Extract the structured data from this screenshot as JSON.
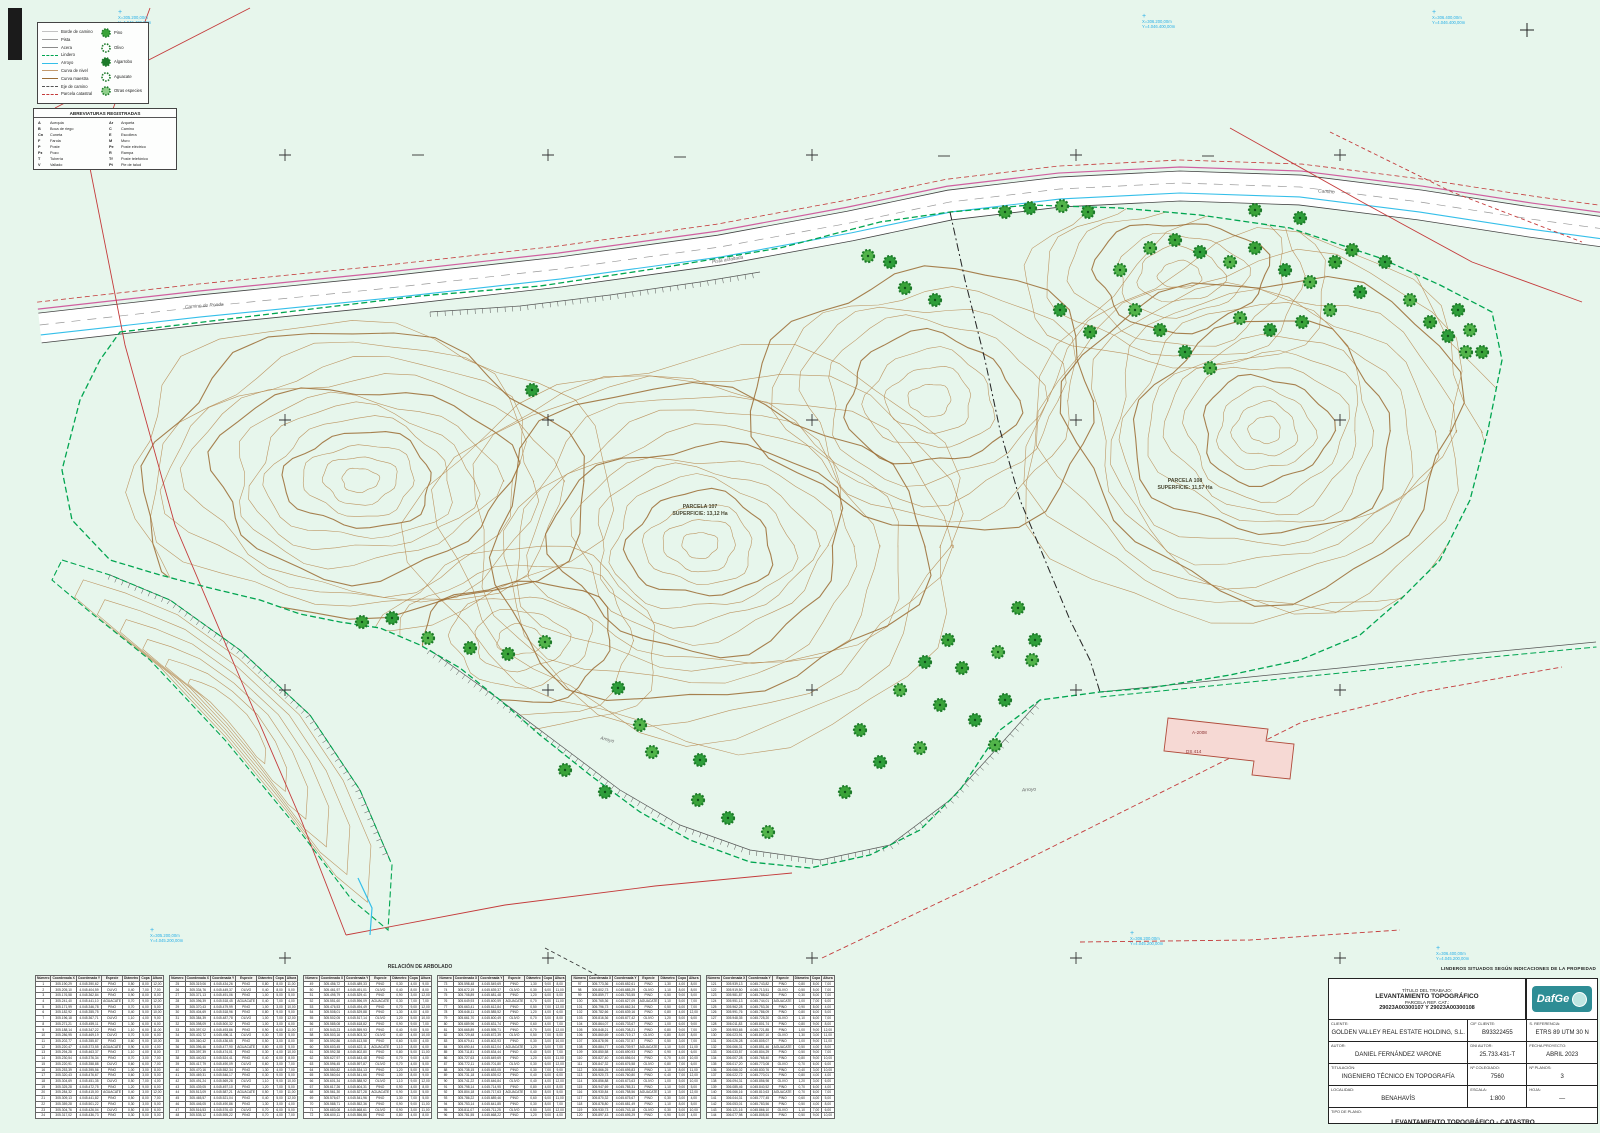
{
  "colors": {
    "bg": "#e7f6ec",
    "contour": "#b5854a",
    "contour_index": "#9a6b33",
    "tree": "#3aa339",
    "tree_dark": "#1d7a2a",
    "boundary_green": "#00a550",
    "red": "#c43b3b",
    "cyan": "#35bfe9",
    "magenta": "#cf5f9f",
    "logo_teal": "#2e8d95",
    "building_fill": "#f6d9d4",
    "building_stroke": "#b04a3a"
  },
  "legend": {
    "line_items": [
      {
        "label": "Borde de camino",
        "color": "#c2c2c2",
        "dash": ""
      },
      {
        "label": "Pista",
        "color": "#9e9e9e",
        "dash": ""
      },
      {
        "label": "Acera",
        "color": "#8a8a8a",
        "dash": ""
      },
      {
        "label": "Lindero",
        "color": "#00a550",
        "dash": "dashed"
      },
      {
        "label": "Arroyo",
        "color": "#35bfe9",
        "dash": ""
      },
      {
        "label": "Curva de nivel",
        "color": "#c49a6c",
        "dash": ""
      },
      {
        "label": "Curva maestra",
        "color": "#9a6b33",
        "dash": ""
      },
      {
        "label": "Eje de camino",
        "color": "#555555",
        "dash": "dashed"
      },
      {
        "label": "Parcela catastral",
        "color": "#c43b3b",
        "dash": "dashed"
      }
    ],
    "tree_items": [
      {
        "label": "Pino",
        "style": "filled"
      },
      {
        "label": "Olivo",
        "style": "outline"
      },
      {
        "label": "Algarrobo",
        "style": "dark"
      },
      {
        "label": "Aguacate",
        "style": "open"
      },
      {
        "label": "Otras especies",
        "style": "hatched"
      }
    ]
  },
  "abbreviations": {
    "title": "ABREVIATURAS REGISTRADAS",
    "items": [
      {
        "abbr": "A",
        "meaning": "Acequia"
      },
      {
        "abbr": "Ar",
        "meaning": "Arqueta"
      },
      {
        "abbr": "B",
        "meaning": "Boca de riego"
      },
      {
        "abbr": "C",
        "meaning": "Camino"
      },
      {
        "abbr": "Cn",
        "meaning": "Cuneta"
      },
      {
        "abbr": "E",
        "meaning": "Escollera"
      },
      {
        "abbr": "F",
        "meaning": "Farola"
      },
      {
        "abbr": "M",
        "meaning": "Muro"
      },
      {
        "abbr": "P",
        "meaning": "Poste"
      },
      {
        "abbr": "Pe",
        "meaning": "Poste eléctrico"
      },
      {
        "abbr": "Pz",
        "meaning": "Pozo"
      },
      {
        "abbr": "R",
        "meaning": "Rampa"
      },
      {
        "abbr": "T",
        "meaning": "Tubería"
      },
      {
        "abbr": "Tf",
        "meaning": "Poste telefónico"
      },
      {
        "abbr": "V",
        "meaning": "Vallado"
      },
      {
        "abbr": "Pt",
        "meaning": "Pie de talud"
      }
    ]
  },
  "coord_markers": [
    {
      "x": 118,
      "y": 10,
      "l1": "X=305.200,00m",
      "l2": "Y=4.046.400,00m"
    },
    {
      "x": 1142,
      "y": 14,
      "l1": "X=306.200,00m",
      "l2": "Y=4.046.400,00m"
    },
    {
      "x": 1432,
      "y": 10,
      "l1": "X=306.400,00m",
      "l2": "Y=4.046.400,00m"
    },
    {
      "x": 150,
      "y": 928,
      "l1": "X=305.200,00m",
      "l2": "Y=4.045.200,00m"
    },
    {
      "x": 1130,
      "y": 931,
      "l1": "X=306.200,00m",
      "l2": "Y=4.045.200,00m"
    },
    {
      "x": 1436,
      "y": 946,
      "l1": "X=306.400,00m",
      "l2": "Y=4.045.200,00m"
    }
  ],
  "parcel_labels": [
    {
      "x": 700,
      "y": 504,
      "line1": "PARCELA 107",
      "line2": "SUPERFICIE: 13,12 Ha"
    },
    {
      "x": 1185,
      "y": 478,
      "line1": "PARCELA 108",
      "line2": "SUPERFICIE: 11,57 Ha"
    }
  ],
  "road_labels": [
    {
      "x": 185,
      "y": 304,
      "rot": -4,
      "text": "Camino de Ronda"
    },
    {
      "x": 712,
      "y": 258,
      "rot": -9,
      "text": "Pista asfaltada"
    },
    {
      "x": 1318,
      "y": 190,
      "rot": 4,
      "text": "Camino"
    },
    {
      "x": 600,
      "y": 738,
      "rot": 14,
      "text": "Arroyo"
    },
    {
      "x": 1022,
      "y": 788,
      "rot": -4,
      "text": "Arroyo"
    }
  ],
  "building": {
    "labels": [
      {
        "x": 1192,
        "y": 730,
        "text": "A-2008"
      },
      {
        "x": 1186,
        "y": 749,
        "text": "DS 414"
      }
    ]
  },
  "tables": {
    "section_title": "RELACIÓN DE ARBOLADO",
    "headers": [
      "Número",
      "Coordenada X",
      "Coordenada Y",
      "Especie",
      "Diámetro",
      "Copa",
      "Altura"
    ],
    "block_count": 6,
    "rows_per_block": 24,
    "start_number": 1,
    "x_base": 305125.03,
    "y_base": 4045311.8,
    "species": [
      "PINO",
      "PINO",
      "OLIVO",
      "PINO",
      "AGUACATE",
      "PINO",
      "PINO",
      "OLIVO"
    ]
  },
  "disclaimer": "LINDEROS SITUADOS SEGÚN INDICACIONES DE LA PROPIEDAD",
  "title_block": {
    "title_lines": [
      "TÍTULO DEL TRABAJO:",
      "LEVANTAMIENTO TOPOGRÁFICO",
      "PARCELA REF. CAT.:",
      "29023A00300107 Y 29023A00300108"
    ],
    "logo_text": "DafGe",
    "rows": [
      [
        {
          "label": "CLIENTE:",
          "value": "GOLDEN VALLEY REAL ESTATE HOLDING, S.L."
        },
        {
          "label": "CIF CLIENTE:",
          "value": "B93322455"
        },
        {
          "label": "S. REFERENCIA:",
          "value": "ETRS 89 UTM 30 N"
        }
      ],
      [
        {
          "label": "AUTOR:",
          "value": "DANIEL FERNÁNDEZ VARONE"
        },
        {
          "label": "DNI AUTOR:",
          "value": "25.733.431-T"
        },
        {
          "label": "FECHA PROYECTO:",
          "value": "ABRIL 2023"
        }
      ],
      [
        {
          "label": "TITULACIÓN:",
          "value": "INGENIERO TÉCNICO EN TOPOGRAFÍA"
        },
        {
          "label": "Nº COLEGIADO:",
          "value": "7560"
        },
        {
          "label": "Nº PLANOS:",
          "value": "3"
        }
      ],
      [
        {
          "label": "LOCALIDAD:",
          "value": "BENAHAVÍS"
        },
        {
          "label": "ESCALA:",
          "value": "1:800"
        },
        {
          "label": "HOJA:",
          "value": "—"
        }
      ]
    ],
    "footer": {
      "label": "TIPO DE PLANO:",
      "value": "LEVANTAMIENTO TOPOGRÁFICO - CATASTRO"
    }
  },
  "geometry": {
    "parcel107": [
      [
        120,
        332
      ],
      [
        220,
        320
      ],
      [
        320,
        308
      ],
      [
        420,
        296
      ],
      [
        540,
        286
      ],
      [
        660,
        268
      ],
      [
        780,
        248
      ],
      [
        880,
        222
      ],
      [
        950,
        212
      ],
      [
        1030,
        205
      ],
      [
        1120,
        208
      ],
      [
        1200,
        215
      ],
      [
        1290,
        228
      ],
      [
        1380,
        258
      ],
      [
        1440,
        285
      ],
      [
        1492,
        312
      ],
      [
        1502,
        360
      ],
      [
        1488,
        430
      ],
      [
        1470,
        500
      ],
      [
        1440,
        560
      ],
      [
        1400,
        600
      ],
      [
        1360,
        635
      ],
      [
        1300,
        660
      ],
      [
        1230,
        675
      ],
      [
        1150,
        688
      ],
      [
        1100,
        692
      ],
      [
        1040,
        700
      ],
      [
        1000,
        730
      ],
      [
        960,
        790
      ],
      [
        920,
        830
      ],
      [
        870,
        855
      ],
      [
        810,
        868
      ],
      [
        750,
        862
      ],
      [
        690,
        840
      ],
      [
        640,
        812
      ],
      [
        590,
        775
      ],
      [
        540,
        735
      ],
      [
        500,
        700
      ],
      [
        460,
        668
      ],
      [
        420,
        645
      ],
      [
        380,
        628
      ],
      [
        340,
        622
      ],
      [
        300,
        614
      ],
      [
        260,
        600
      ],
      [
        210,
        588
      ],
      [
        160,
        575
      ],
      [
        110,
        560
      ],
      [
        72,
        520
      ],
      [
        62,
        470
      ],
      [
        80,
        400
      ],
      [
        100,
        360
      ]
    ],
    "tail": [
      [
        62,
        560
      ],
      [
        110,
        575
      ],
      [
        170,
        600
      ],
      [
        240,
        650
      ],
      [
        310,
        715
      ],
      [
        360,
        790
      ],
      [
        392,
        865
      ],
      [
        388,
        930
      ],
      [
        352,
        900
      ],
      [
        295,
        825
      ],
      [
        225,
        740
      ],
      [
        150,
        660
      ],
      [
        90,
        612
      ],
      [
        52,
        580
      ]
    ],
    "divider": [
      [
        950,
        212
      ],
      [
        965,
        280
      ],
      [
        985,
        360
      ],
      [
        1000,
        430
      ],
      [
        1020,
        500
      ],
      [
        1045,
        560
      ],
      [
        1070,
        620
      ],
      [
        1090,
        660
      ],
      [
        1100,
        692
      ]
    ],
    "road": [
      [
        40,
        328
      ],
      [
        200,
        310
      ],
      [
        380,
        292
      ],
      [
        560,
        272
      ],
      [
        720,
        250
      ],
      [
        850,
        226
      ],
      [
        950,
        205
      ],
      [
        1060,
        192
      ],
      [
        1180,
        186
      ],
      [
        1300,
        190
      ],
      [
        1420,
        205
      ],
      [
        1530,
        222
      ],
      [
        1604,
        232
      ]
    ],
    "east_track": [
      [
        1100,
        692
      ],
      [
        1220,
        680
      ],
      [
        1340,
        668
      ],
      [
        1460,
        655
      ],
      [
        1596,
        642
      ]
    ],
    "red_lines": [
      {
        "pts": [
          [
            88,
            158
          ],
          [
            125,
            345
          ],
          [
            175,
            525
          ],
          [
            243,
            685
          ],
          [
            302,
            822
          ],
          [
            346,
            935
          ]
        ],
        "dash": ""
      },
      {
        "pts": [
          [
            150,
            8
          ],
          [
            95,
            158
          ]
        ],
        "dash": ""
      },
      {
        "pts": [
          [
            55,
            108
          ],
          [
            250,
            8
          ]
        ],
        "dash": ""
      },
      {
        "pts": [
          [
            346,
            935
          ],
          [
            505,
            905
          ],
          [
            655,
            886
          ],
          [
            792,
            873
          ]
        ],
        "dash": ""
      },
      {
        "pts": [
          [
            822,
            958
          ],
          [
            982,
            882
          ],
          [
            1142,
            802
          ],
          [
            1302,
            722
          ],
          [
            1422,
            692
          ],
          [
            1562,
            667
          ]
        ],
        "dash": "5 3"
      },
      {
        "pts": [
          [
            1230,
            128
          ],
          [
            1362,
            202
          ],
          [
            1472,
            262
          ],
          [
            1582,
            302
          ]
        ],
        "dash": ""
      },
      {
        "pts": [
          [
            1330,
            132
          ],
          [
            1452,
            192
          ],
          [
            1582,
            242
          ]
        ],
        "dash": "4 3"
      },
      {
        "pts": [
          [
            1080,
            942
          ],
          [
            1250,
            940
          ],
          [
            1400,
            930
          ]
        ],
        "dash": "5 3"
      }
    ],
    "cyan_extra": [
      [
        [
          358,
          878
        ],
        [
          372,
          908
        ],
        [
          370,
          935
        ]
      ]
    ],
    "hachures": [
      [
        [
          430,
          650
        ],
        [
          500,
          700
        ],
        [
          560,
          745
        ],
        [
          620,
          790
        ],
        [
          680,
          825
        ],
        [
          750,
          850
        ],
        [
          820,
          860
        ],
        [
          890,
          845
        ],
        [
          950,
          800
        ],
        [
          1000,
          745
        ],
        [
          1040,
          700
        ]
      ],
      [
        [
          430,
          312
        ],
        [
          520,
          306
        ],
        [
          610,
          295
        ],
        [
          700,
          282
        ],
        [
          760,
          272
        ]
      ],
      [
        [
          110,
          575
        ],
        [
          170,
          600
        ],
        [
          240,
          650
        ],
        [
          310,
          715
        ],
        [
          360,
          790
        ],
        [
          390,
          860
        ]
      ]
    ],
    "building_poly": [
      [
        1168,
        718
      ],
      [
        1268,
        729
      ],
      [
        1266,
        741
      ],
      [
        1294,
        744
      ],
      [
        1290,
        779
      ],
      [
        1252,
        775
      ],
      [
        1254,
        761
      ],
      [
        1164,
        751
      ]
    ],
    "contour_lobes": [
      {
        "cx": 360,
        "cy": 480,
        "rx": 240,
        "ry": 155,
        "n": 13,
        "seed": 1
      },
      {
        "cx": 700,
        "cy": 545,
        "rx": 270,
        "ry": 195,
        "n": 15,
        "seed": 2
      },
      {
        "cx": 930,
        "cy": 400,
        "rx": 170,
        "ry": 130,
        "n": 8,
        "seed": 3
      },
      {
        "cx": 1265,
        "cy": 430,
        "rx": 240,
        "ry": 200,
        "n": 15,
        "seed": 4
      },
      {
        "cx": 1180,
        "cy": 275,
        "rx": 150,
        "ry": 95,
        "n": 7,
        "seed": 5
      },
      {
        "cx": 520,
        "cy": 640,
        "rx": 140,
        "ry": 90,
        "n": 6,
        "seed": 6
      }
    ],
    "tail_rings": 6,
    "grid_cross_cols": [
      285,
      548,
      812,
      1076,
      1340
    ],
    "grid_cross_rows": [
      155,
      420,
      690,
      958
    ],
    "minus_marks": [
      [
        418,
        155
      ],
      [
        680,
        157
      ],
      [
        944,
        156
      ],
      [
        1208,
        156
      ]
    ],
    "edge_cross": [
      1527,
      30
    ],
    "trees": [
      [
        1005,
        212
      ],
      [
        1030,
        208
      ],
      [
        1062,
        206
      ],
      [
        1088,
        212
      ],
      [
        890,
        262
      ],
      [
        868,
        256
      ],
      [
        905,
        288
      ],
      [
        935,
        300
      ],
      [
        1150,
        248
      ],
      [
        1175,
        240
      ],
      [
        1200,
        252
      ],
      [
        1230,
        262
      ],
      [
        1255,
        248
      ],
      [
        1285,
        270
      ],
      [
        1310,
        282
      ],
      [
        1335,
        262
      ],
      [
        1360,
        292
      ],
      [
        1330,
        310
      ],
      [
        1302,
        322
      ],
      [
        1270,
        330
      ],
      [
        1240,
        318
      ],
      [
        1352,
        250
      ],
      [
        1385,
        262
      ],
      [
        1410,
        300
      ],
      [
        1430,
        322
      ],
      [
        1448,
        336
      ],
      [
        1466,
        352
      ],
      [
        1255,
        210
      ],
      [
        1300,
        218
      ],
      [
        1135,
        310
      ],
      [
        1160,
        330
      ],
      [
        1185,
        352
      ],
      [
        1210,
        368
      ],
      [
        1090,
        332
      ],
      [
        1060,
        310
      ],
      [
        1120,
        270
      ],
      [
        1018,
        608
      ],
      [
        1035,
        640
      ],
      [
        998,
        652
      ],
      [
        962,
        668
      ],
      [
        1005,
        700
      ],
      [
        1032,
        660
      ],
      [
        948,
        640
      ],
      [
        925,
        662
      ],
      [
        900,
        690
      ],
      [
        940,
        705
      ],
      [
        975,
        720
      ],
      [
        995,
        745
      ],
      [
        565,
        770
      ],
      [
        605,
        792
      ],
      [
        652,
        752
      ],
      [
        698,
        800
      ],
      [
        728,
        818
      ],
      [
        768,
        832
      ],
      [
        845,
        792
      ],
      [
        880,
        762
      ],
      [
        920,
        748
      ],
      [
        860,
        730
      ],
      [
        700,
        760
      ],
      [
        640,
        725
      ],
      [
        362,
        622
      ],
      [
        392,
        618
      ],
      [
        428,
        638
      ],
      [
        470,
        648
      ],
      [
        532,
        390
      ],
      [
        545,
        642
      ],
      [
        508,
        654
      ],
      [
        618,
        688
      ],
      [
        1470,
        330
      ],
      [
        1482,
        352
      ],
      [
        1458,
        310
      ]
    ]
  }
}
